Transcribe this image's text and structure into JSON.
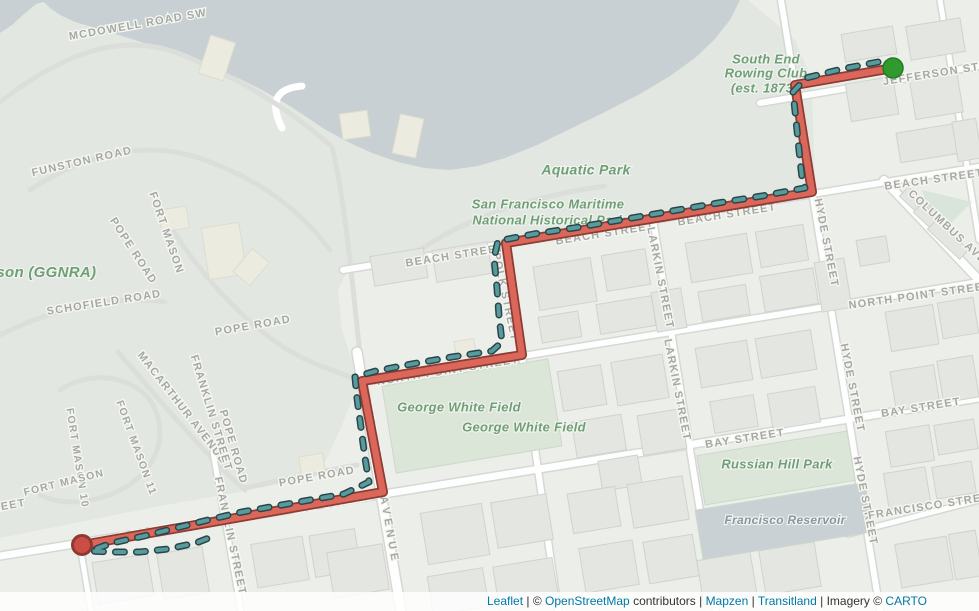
{
  "map": {
    "width": 979,
    "height": 611,
    "colors": {
      "urban": "#eceee9",
      "green_land": "#e2e8e1",
      "water": "#c8d0d3",
      "road_fill": "#fefefe",
      "road_casing": "#d5d8d3",
      "building_fill": "#e4e6e1",
      "building_stroke": "#d0d3cd",
      "park_fill": "#dbe5d8",
      "reservoir_fill": "#c9d1d5",
      "street_label": "#a6a8a3",
      "area_label_green": "#6f9e77",
      "reservoir_label": "#8895a2",
      "route_fill": "#db675a",
      "route_casing": "#8d3b33",
      "trace_fill": "#599a9c",
      "trace_casing": "#28464a",
      "marker_start": "#2f9b2f",
      "marker_start_stroke": "#217c21",
      "marker_end": "#cb4e46",
      "marker_end_stroke": "#8e3a31",
      "link_blue": "#0079a8"
    },
    "street_labels": [
      {
        "t": "MCDOWELL ROAD SW",
        "x": 138,
        "y": 25,
        "r": -10
      },
      {
        "t": "FUNSTON ROAD",
        "x": 82,
        "y": 162,
        "r": -13
      },
      {
        "t": "FORT MASON",
        "x": 166,
        "y": 233,
        "r": 71
      },
      {
        "t": "POPE ROAD",
        "x": 133,
        "y": 251,
        "r": 57
      },
      {
        "t": "SCHOFIELD ROAD",
        "x": 104,
        "y": 303,
        "r": -9
      },
      {
        "t": "POPE ROAD",
        "x": 253,
        "y": 326,
        "r": -10
      },
      {
        "t": "MACARTHUR AVENUE",
        "x": 182,
        "y": 408,
        "r": 52
      },
      {
        "t": "FRANKLIN STREET",
        "x": 211,
        "y": 413,
        "r": 73
      },
      {
        "t": "POPE ROAD",
        "x": 233,
        "y": 447,
        "r": 74
      },
      {
        "t": "FORT MASON 11",
        "x": 136,
        "y": 448,
        "r": 70,
        "s": 10.5
      },
      {
        "t": "FORT MASON 10",
        "x": 77,
        "y": 458,
        "r": 81,
        "s": 10.5
      },
      {
        "t": "FORT MASON",
        "x": 64,
        "y": 483,
        "r": -14,
        "s": 10.5
      },
      {
        "t": "POPE ROAD",
        "x": 317,
        "y": 477,
        "r": -10
      },
      {
        "t": "BAY STREET",
        "x": 160,
        "y": 531,
        "r": -10
      },
      {
        "t": "FRANKLIN STREET",
        "x": 230,
        "y": 536,
        "r": 78
      },
      {
        "t": "BAY STREET",
        "x": 333,
        "y": 503,
        "r": -10
      },
      {
        "t": "VAN NESS AVENUE",
        "x": 381,
        "y": 484,
        "r": 80,
        "sp": 4
      },
      {
        "t": "NORTH POINT STREET",
        "x": 448,
        "y": 371,
        "r": -9
      },
      {
        "t": "POLK STREET",
        "x": 505,
        "y": 297,
        "r": 78
      },
      {
        "t": "BEACH STREET",
        "x": 455,
        "y": 256,
        "r": -9
      },
      {
        "t": "BEACH STREET",
        "x": 605,
        "y": 234,
        "r": -9
      },
      {
        "t": "BEACH STREET",
        "x": 727,
        "y": 215,
        "r": -9
      },
      {
        "t": "BEACH STREET",
        "x": 934,
        "y": 180,
        "r": -8
      },
      {
        "t": "LARKIN STREET",
        "x": 660,
        "y": 278,
        "r": 79
      },
      {
        "t": "LARKIN STREET",
        "x": 677,
        "y": 390,
        "r": 79
      },
      {
        "t": "NORTH POINT STREET",
        "x": 920,
        "y": 296,
        "r": -8
      },
      {
        "t": "BAY STREET",
        "x": 745,
        "y": 439,
        "r": -9
      },
      {
        "t": "BAY STREET",
        "x": 921,
        "y": 408,
        "r": -9
      },
      {
        "t": "HYDE STREET",
        "x": 826,
        "y": 243,
        "r": 79
      },
      {
        "t": "HYDE STREET",
        "x": 852,
        "y": 388,
        "r": 79
      },
      {
        "t": "HYDE STREET",
        "x": 865,
        "y": 501,
        "r": 79
      },
      {
        "t": "FRANCISCO STREET",
        "x": 933,
        "y": 506,
        "r": -9
      },
      {
        "t": "JEFFERSON STREET",
        "x": 948,
        "y": 72,
        "r": -9
      },
      {
        "t": "COLUMBUS AVE",
        "x": 947,
        "y": 227,
        "r": 43
      },
      {
        "t": "BAY STREET",
        "x": -14,
        "y": 510,
        "r": -10
      }
    ],
    "area_labels": [
      {
        "t": "Aquatic Park",
        "x": 586,
        "y": 171,
        "s": 14
      },
      {
        "t": "San Francisco Maritime",
        "x": 548,
        "y": 205,
        "s": 13
      },
      {
        "t": "National Historical Park",
        "x": 549,
        "y": 221,
        "s": 13
      },
      {
        "t": "South End",
        "x": 766,
        "y": 60,
        "s": 13
      },
      {
        "t": "Rowing Club",
        "x": 766,
        "y": 74,
        "s": 13
      },
      {
        "t": "(est. 1873",
        "x": 762,
        "y": 89,
        "s": 13
      },
      {
        "t": "George White Field",
        "x": 459,
        "y": 408,
        "s": 13
      },
      {
        "t": "George White Field",
        "x": 524,
        "y": 428,
        "s": 13
      },
      {
        "t": "Russian Hill Park",
        "x": 777,
        "y": 465,
        "s": 13
      },
      {
        "t": "Francisco Reservoir",
        "x": 785,
        "y": 521,
        "s": 12,
        "c": "#8895a2"
      },
      {
        "t": "ason (GGNRA)",
        "x": 42,
        "y": 273,
        "s": 15
      }
    ],
    "route": {
      "points": [
        [
          893,
          68
        ],
        [
          795,
          85
        ],
        [
          812,
          192
        ],
        [
          506,
          243
        ],
        [
          522,
          355
        ],
        [
          362,
          381
        ],
        [
          383,
          492
        ],
        [
          82,
          545
        ]
      ]
    },
    "trace": {
      "points": [
        [
          878,
          62
        ],
        [
          842,
          69
        ],
        [
          806,
          78
        ],
        [
          793,
          92
        ],
        [
          796,
          120
        ],
        [
          799,
          150
        ],
        [
          802,
          178
        ],
        [
          805,
          188
        ],
        [
          762,
          196
        ],
        [
          718,
          203
        ],
        [
          672,
          211
        ],
        [
          626,
          219
        ],
        [
          580,
          227
        ],
        [
          534,
          234
        ],
        [
          498,
          241
        ],
        [
          494,
          258
        ],
        [
          497,
          288
        ],
        [
          499,
          316
        ],
        [
          502,
          342
        ],
        [
          492,
          351
        ],
        [
          452,
          357
        ],
        [
          412,
          364
        ],
        [
          376,
          371
        ],
        [
          355,
          377
        ],
        [
          357,
          398
        ],
        [
          361,
          428
        ],
        [
          365,
          458
        ],
        [
          369,
          482
        ],
        [
          344,
          494
        ],
        [
          310,
          500
        ],
        [
          276,
          506
        ],
        [
          242,
          512
        ],
        [
          208,
          520
        ],
        [
          176,
          528
        ],
        [
          144,
          536
        ],
        [
          112,
          543
        ],
        [
          90,
          551
        ],
        [
          112,
          552
        ],
        [
          140,
          552
        ],
        [
          168,
          549
        ],
        [
          196,
          543
        ],
        [
          214,
          536
        ]
      ]
    },
    "markers": {
      "start": {
        "x": 893,
        "y": 68,
        "r": 10
      },
      "end": {
        "x": 82,
        "y": 545,
        "r": 9.5
      }
    }
  },
  "attribution": {
    "parts": [
      {
        "text": "Leaflet",
        "link": true
      },
      {
        "text": " | ",
        "link": false
      },
      {
        "text": "© ",
        "link": false
      },
      {
        "text": "OpenStreetMap",
        "link": true
      },
      {
        "text": " contributors",
        "link": false
      },
      {
        "text": " | ",
        "link": false
      },
      {
        "text": "Mapzen",
        "link": true
      },
      {
        "text": " | ",
        "link": false
      },
      {
        "text": "Transitland",
        "link": true
      },
      {
        "text": " | ",
        "link": false
      },
      {
        "text": "Imagery © ",
        "link": false
      },
      {
        "text": "CARTO",
        "link": true
      }
    ]
  }
}
